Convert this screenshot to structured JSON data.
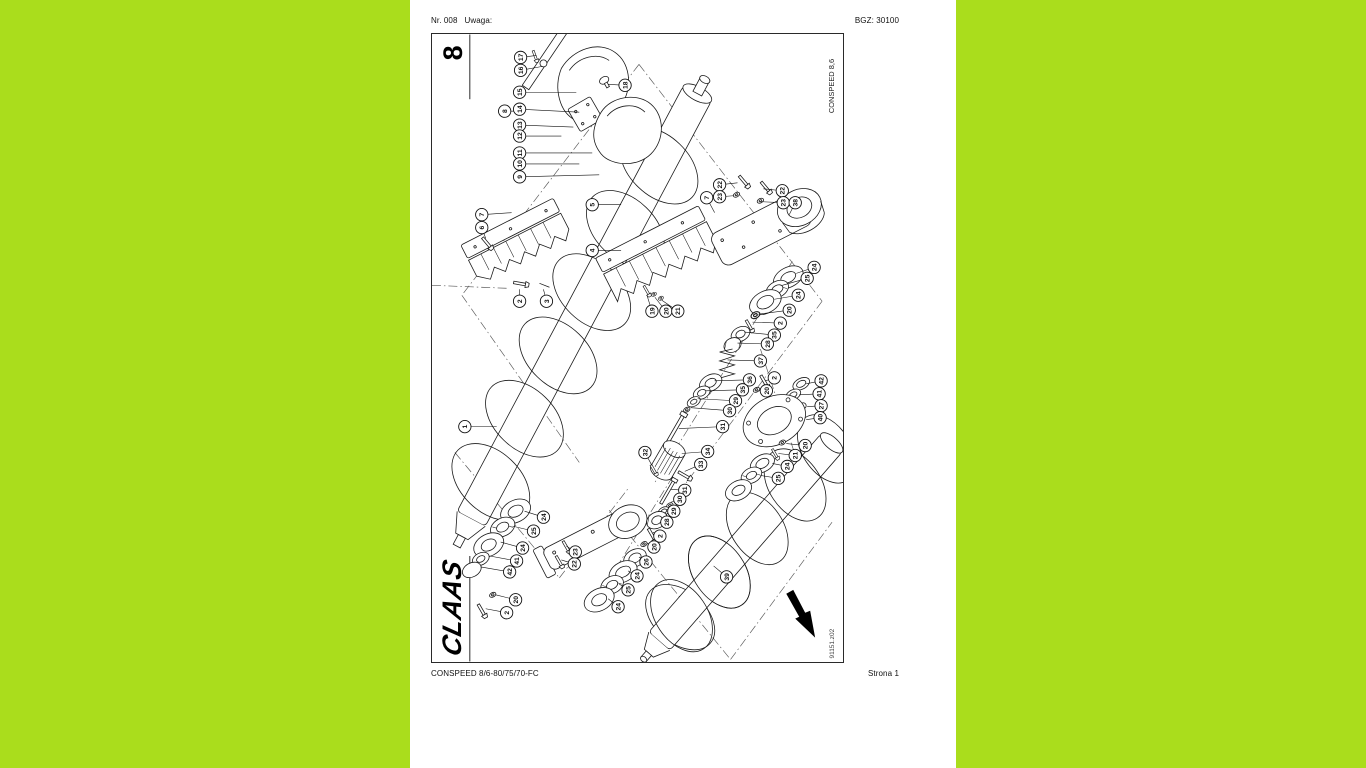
{
  "page": {
    "colors": {
      "margin_green": "#aadd1c",
      "paper": "#ffffff",
      "ink": "#1a1a1a"
    },
    "header": {
      "left": "Nr. 008   Uwaga:",
      "right": "BGZ: 30100"
    },
    "footer": {
      "left": "CONSPEED 8/6-80/75/70-FC",
      "right": "Strona 1"
    }
  },
  "diagram": {
    "sheet_number": "8",
    "model_label": "CONSPEED 8,6",
    "drawing_code": "91151.z02",
    "brand_logo": "CLAAS",
    "balloons": [
      {
        "n": "17",
        "x": 89,
        "y": 23,
        "lx": 105,
        "ly": 21
      },
      {
        "n": "16",
        "x": 89,
        "y": 36,
        "lx": 111,
        "ly": 32
      },
      {
        "n": "15",
        "x": 88,
        "y": 58,
        "lx": 145,
        "ly": 58
      },
      {
        "n": "14",
        "x": 88,
        "y": 75,
        "lx": 148,
        "ly": 78
      },
      {
        "n": "13",
        "x": 88,
        "y": 91,
        "lx": 142,
        "ly": 93
      },
      {
        "n": "12",
        "x": 88,
        "y": 102,
        "lx": 130,
        "ly": 102
      },
      {
        "n": "11",
        "x": 88,
        "y": 119,
        "lx": 161,
        "ly": 119
      },
      {
        "n": "10",
        "x": 88,
        "y": 130,
        "lx": 148,
        "ly": 130
      },
      {
        "n": "9",
        "x": 88,
        "y": 143,
        "lx": 168,
        "ly": 141
      },
      {
        "n": "8",
        "x": 73,
        "y": 77,
        "lx": 82,
        "ly": 77
      },
      {
        "n": "18",
        "x": 194,
        "y": 51,
        "lx": 177,
        "ly": 50
      },
      {
        "n": "7",
        "x": 50,
        "y": 181,
        "lx": 80,
        "ly": 179
      },
      {
        "n": "6",
        "x": 50,
        "y": 194,
        "lx": 54,
        "ly": 205
      },
      {
        "n": "5",
        "x": 161,
        "y": 171,
        "lx": 190,
        "ly": 171
      },
      {
        "n": "4",
        "x": 161,
        "y": 217,
        "lx": 190,
        "ly": 217
      },
      {
        "n": "2",
        "x": 88,
        "y": 268,
        "lx": 88,
        "ly": 256
      },
      {
        "n": "3",
        "x": 115,
        "y": 268,
        "lx": 112,
        "ly": 256
      },
      {
        "n": "22",
        "x": 289,
        "y": 151,
        "lx": 307,
        "ly": 149
      },
      {
        "n": "23",
        "x": 289,
        "y": 163,
        "lx": 303,
        "ly": 162
      },
      {
        "n": "7",
        "x": 276,
        "y": 164,
        "lx": 284,
        "ly": 179
      },
      {
        "n": "22",
        "x": 352,
        "y": 157,
        "lx": 333,
        "ly": 155
      },
      {
        "n": "23",
        "x": 353,
        "y": 169,
        "lx": 331,
        "ly": 168
      },
      {
        "n": "38",
        "x": 365,
        "y": 169,
        "lx": 359,
        "ly": 181
      },
      {
        "n": "19",
        "x": 221,
        "y": 278,
        "lx": 216,
        "ly": 262
      },
      {
        "n": "20",
        "x": 235,
        "y": 278,
        "lx": 224,
        "ly": 264
      },
      {
        "n": "21",
        "x": 247,
        "y": 278,
        "lx": 231,
        "ly": 267
      },
      {
        "n": "24",
        "x": 384,
        "y": 234,
        "lx": 366,
        "ly": 240
      },
      {
        "n": "25",
        "x": 377,
        "y": 245,
        "lx": 352,
        "ly": 252
      },
      {
        "n": "24",
        "x": 368,
        "y": 262,
        "lx": 344,
        "ly": 266
      },
      {
        "n": "20",
        "x": 359,
        "y": 277,
        "lx": 328,
        "ly": 281
      },
      {
        "n": "2",
        "x": 350,
        "y": 290,
        "lx": 322,
        "ly": 289
      },
      {
        "n": "35",
        "x": 344,
        "y": 302,
        "lx": 314,
        "ly": 299
      },
      {
        "n": "28",
        "x": 337,
        "y": 311,
        "lx": 307,
        "ly": 310
      },
      {
        "n": "37",
        "x": 330,
        "y": 328,
        "lx": 297,
        "ly": 327
      },
      {
        "n": "36",
        "x": 319,
        "y": 347,
        "lx": 284,
        "ly": 348
      },
      {
        "n": "35",
        "x": 312,
        "y": 357,
        "lx": 275,
        "ly": 358
      },
      {
        "n": "29",
        "x": 305,
        "y": 368,
        "lx": 267,
        "ly": 366
      },
      {
        "n": "30",
        "x": 299,
        "y": 378,
        "lx": 260,
        "ly": 375
      },
      {
        "n": "31",
        "x": 292,
        "y": 394,
        "lx": 248,
        "ly": 396
      },
      {
        "n": "34",
        "x": 277,
        "y": 419,
        "lx": 251,
        "ly": 421
      },
      {
        "n": "33",
        "x": 270,
        "y": 432,
        "lx": 254,
        "ly": 439
      },
      {
        "n": "2",
        "x": 344,
        "y": 345,
        "lx": 335,
        "ly": 348
      },
      {
        "n": "20",
        "x": 336,
        "y": 358,
        "lx": 328,
        "ly": 358
      },
      {
        "n": "42",
        "x": 391,
        "y": 348,
        "lx": 376,
        "ly": 351
      },
      {
        "n": "41",
        "x": 389,
        "y": 361,
        "lx": 369,
        "ly": 362
      },
      {
        "n": "27",
        "x": 391,
        "y": 373,
        "lx": 377,
        "ly": 374
      },
      {
        "n": "40",
        "x": 390,
        "y": 385,
        "lx": 376,
        "ly": 387
      },
      {
        "n": "20",
        "x": 375,
        "y": 413,
        "lx": 356,
        "ly": 411
      },
      {
        "n": "21",
        "x": 365,
        "y": 423,
        "lx": 348,
        "ly": 421
      },
      {
        "n": "24",
        "x": 357,
        "y": 434,
        "lx": 342,
        "ly": 431
      },
      {
        "n": "25",
        "x": 348,
        "y": 446,
        "lx": 330,
        "ly": 443
      },
      {
        "n": "32",
        "x": 214,
        "y": 420,
        "lx": 221,
        "ly": 433
      },
      {
        "n": "31",
        "x": 254,
        "y": 458,
        "lx": 240,
        "ly": 457
      },
      {
        "n": "30",
        "x": 249,
        "y": 467,
        "lx": 240,
        "ly": 470
      },
      {
        "n": "29",
        "x": 243,
        "y": 479,
        "lx": 236,
        "ly": 477
      },
      {
        "n": "28",
        "x": 236,
        "y": 490,
        "lx": 231,
        "ly": 487
      },
      {
        "n": "2",
        "x": 229,
        "y": 504,
        "lx": 222,
        "ly": 500
      },
      {
        "n": "20",
        "x": 223,
        "y": 515,
        "lx": 216,
        "ly": 511
      },
      {
        "n": "26",
        "x": 215,
        "y": 530,
        "lx": 208,
        "ly": 525
      },
      {
        "n": "24",
        "x": 206,
        "y": 544,
        "lx": 197,
        "ly": 539
      },
      {
        "n": "25",
        "x": 197,
        "y": 558,
        "lx": 188,
        "ly": 552
      },
      {
        "n": "24",
        "x": 187,
        "y": 575,
        "lx": 177,
        "ly": 567
      },
      {
        "n": "1",
        "x": 33,
        "y": 394,
        "lx": 65,
        "ly": 394
      },
      {
        "n": "24",
        "x": 112,
        "y": 485,
        "lx": 93,
        "ly": 479
      },
      {
        "n": "25",
        "x": 102,
        "y": 499,
        "lx": 81,
        "ly": 494
      },
      {
        "n": "24",
        "x": 91,
        "y": 516,
        "lx": 69,
        "ly": 510
      },
      {
        "n": "41",
        "x": 85,
        "y": 529,
        "lx": 58,
        "ly": 524
      },
      {
        "n": "42",
        "x": 78,
        "y": 540,
        "lx": 49,
        "ly": 535
      },
      {
        "n": "20",
        "x": 84,
        "y": 568,
        "lx": 64,
        "ly": 563
      },
      {
        "n": "2",
        "x": 75,
        "y": 581,
        "lx": 54,
        "ly": 577
      },
      {
        "n": "23",
        "x": 144,
        "y": 520,
        "lx": 135,
        "ly": 514
      },
      {
        "n": "22",
        "x": 143,
        "y": 532,
        "lx": 130,
        "ly": 528
      },
      {
        "n": "39",
        "x": 296,
        "y": 545,
        "lx": 283,
        "ly": 534
      }
    ]
  }
}
